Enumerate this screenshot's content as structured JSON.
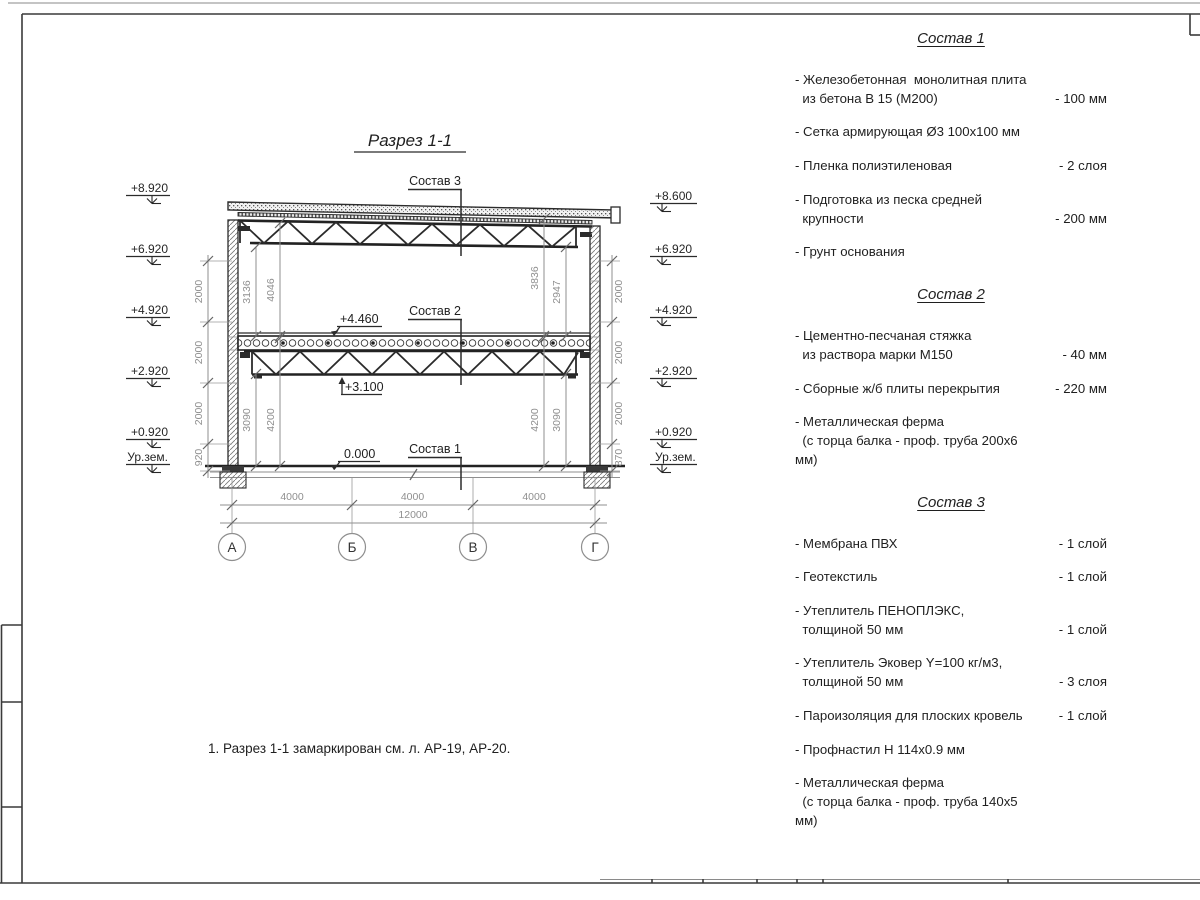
{
  "colors": {
    "line": "#2b2b2b",
    "dim_gray": "#8f8f8f",
    "paper": "#ffffff"
  },
  "drawing": {
    "title": "Разрез 1-1",
    "sostav1_label": "Состав 1",
    "sostav2_label": "Состав 2",
    "sostav3_label": "Состав 3",
    "level_zero": "0.000",
    "level_plus3100": "+3.100",
    "level_plus4460": "+4.460",
    "left_marks": [
      "+8.920",
      "+6.920",
      "+4.920",
      "+2.920",
      "+0.920",
      "Ур.зем."
    ],
    "right_marks": [
      "+8.600",
      "+6.920",
      "+4.920",
      "+2.920",
      "+0.920",
      "Ур.зем."
    ],
    "left_chain": [
      "2000",
      "2000",
      "2000",
      "920"
    ],
    "right_chain": [
      "2000",
      "2000",
      "2000",
      "870"
    ],
    "upper_left_dims": [
      "3136",
      "4046"
    ],
    "upper_right_dims": [
      "3836",
      "2947"
    ],
    "lower_left_dims": [
      "3090",
      "4200"
    ],
    "lower_right_dims": [
      "4200",
      "3090"
    ],
    "bottom_dims": [
      "4000",
      "4000",
      "4000"
    ],
    "total_dim": "12000",
    "axes": [
      "А",
      "Б",
      "В",
      "Г"
    ]
  },
  "note": "1. Разрез 1-1 замаркирован см. л. АР-19, АР-20.",
  "compositions": [
    {
      "title": "Состав 1",
      "items": [
        {
          "name": "- Железобетонная  монолитная плита\n  из бетона В 15 (М200)",
          "value": "- 100 мм"
        },
        {
          "name": "- Сетка армирующая Ø3 100х100 мм",
          "value": ""
        },
        {
          "name": "- Пленка полиэтиленовая",
          "value": "-  2 слоя"
        },
        {
          "name": "- Подготовка из песка средней\n  крупности",
          "value": "- 200 мм"
        },
        {
          "name": "- Грунт основания",
          "value": ""
        }
      ]
    },
    {
      "title": "Состав 2",
      "items": [
        {
          "name": "- Цементно-песчаная стяжка\n  из раствора марки М150",
          "value": "- 40 мм"
        },
        {
          "name": "- Сборные ж/б плиты перекрытия",
          "value": "- 220 мм"
        },
        {
          "name": "- Металлическая ферма\n  (с торца балка - проф. труба 200х6 мм)",
          "value": ""
        }
      ]
    },
    {
      "title": "Состав 3",
      "items": [
        {
          "name": "- Мембрана ПВХ",
          "value": "- 1 слой"
        },
        {
          "name": "- Геотекстиль",
          "value": "- 1 слой"
        },
        {
          "name": "- Утеплитель ПЕНОПЛЭКС,\n  толщиной 50 мм",
          "value": "- 1 слой"
        },
        {
          "name": "- Утеплитель Эковер Y=100 кг/м3,\n  толщиной 50 мм",
          "value": "- 3 слоя"
        },
        {
          "name": "- Пароизоляция для плоских кровель",
          "value": "- 1 слой"
        },
        {
          "name": "- Профнастил Н 114х0.9 мм",
          "value": ""
        },
        {
          "name": "- Металлическая ферма\n  (с торца балка - проф. труба 140х5 мм)",
          "value": ""
        }
      ]
    }
  ]
}
